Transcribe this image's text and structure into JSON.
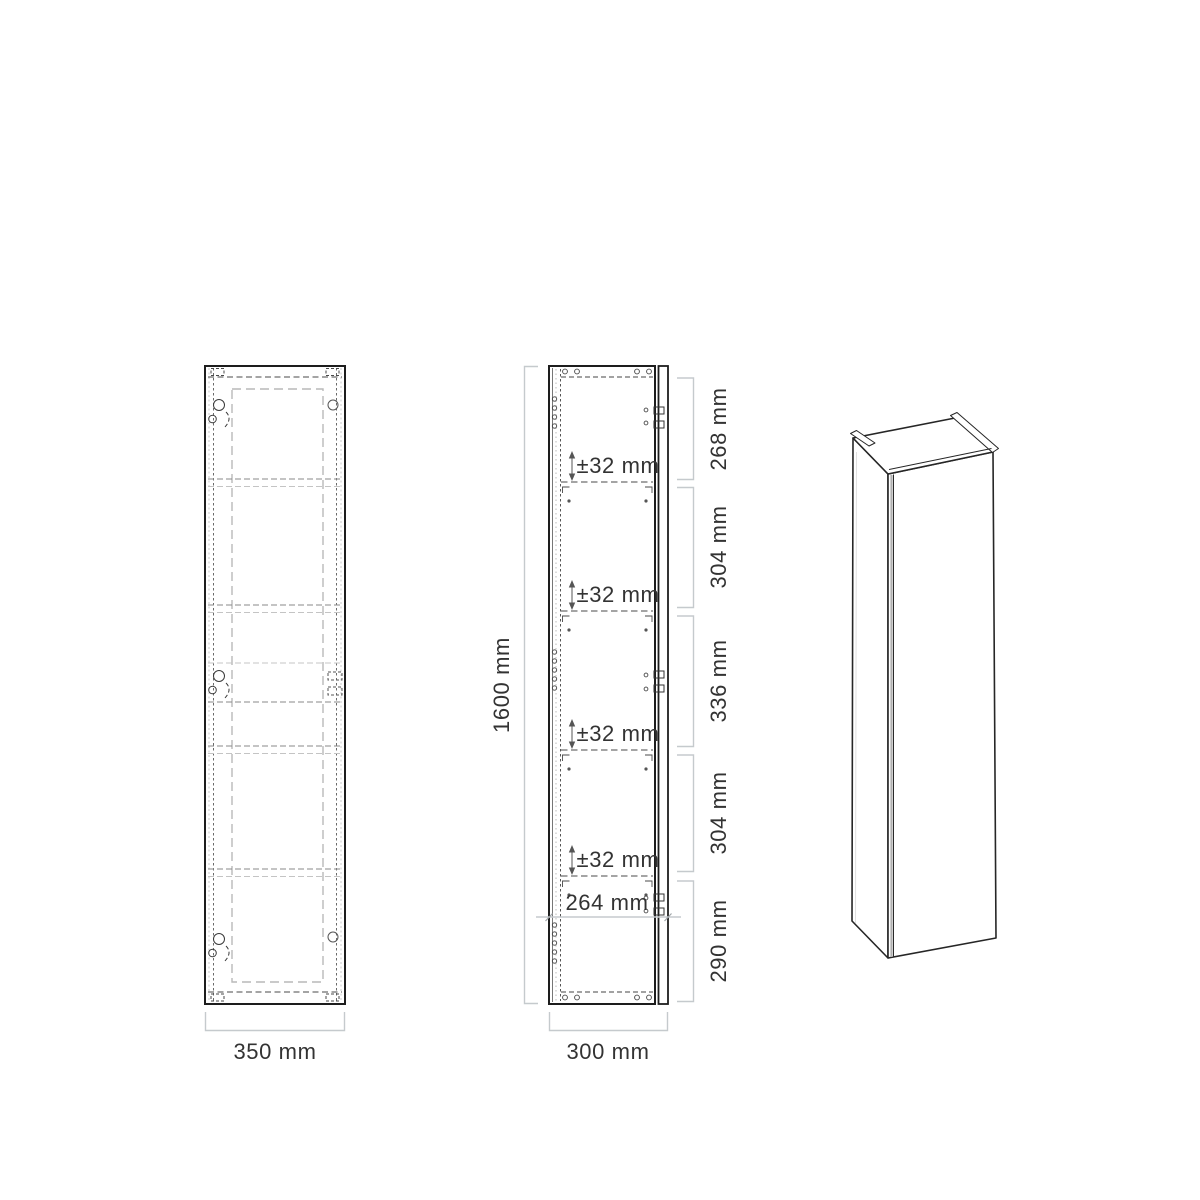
{
  "colors": {
    "outline": "#1d1d1d",
    "inner_dash_dark": "#4a4a4a",
    "inner_dash_light": "#c4c4c4",
    "dimension_line": "#c5cacd",
    "text": "#333333"
  },
  "views": {
    "front": {
      "title": "front-view",
      "width_label": "350 mm"
    },
    "side": {
      "title": "side-section-view",
      "height_label": "1600 mm",
      "width_label": "300 mm",
      "bottom_inner_label": "264 mm",
      "shelf_adjust_labels": [
        "±32 mm",
        "±32 mm",
        "±32 mm",
        "±32 mm"
      ],
      "segment_labels": [
        "268 mm",
        "304 mm",
        "336 mm",
        "304 mm",
        "290 mm"
      ]
    },
    "isometric": {
      "title": "isometric-view"
    }
  }
}
